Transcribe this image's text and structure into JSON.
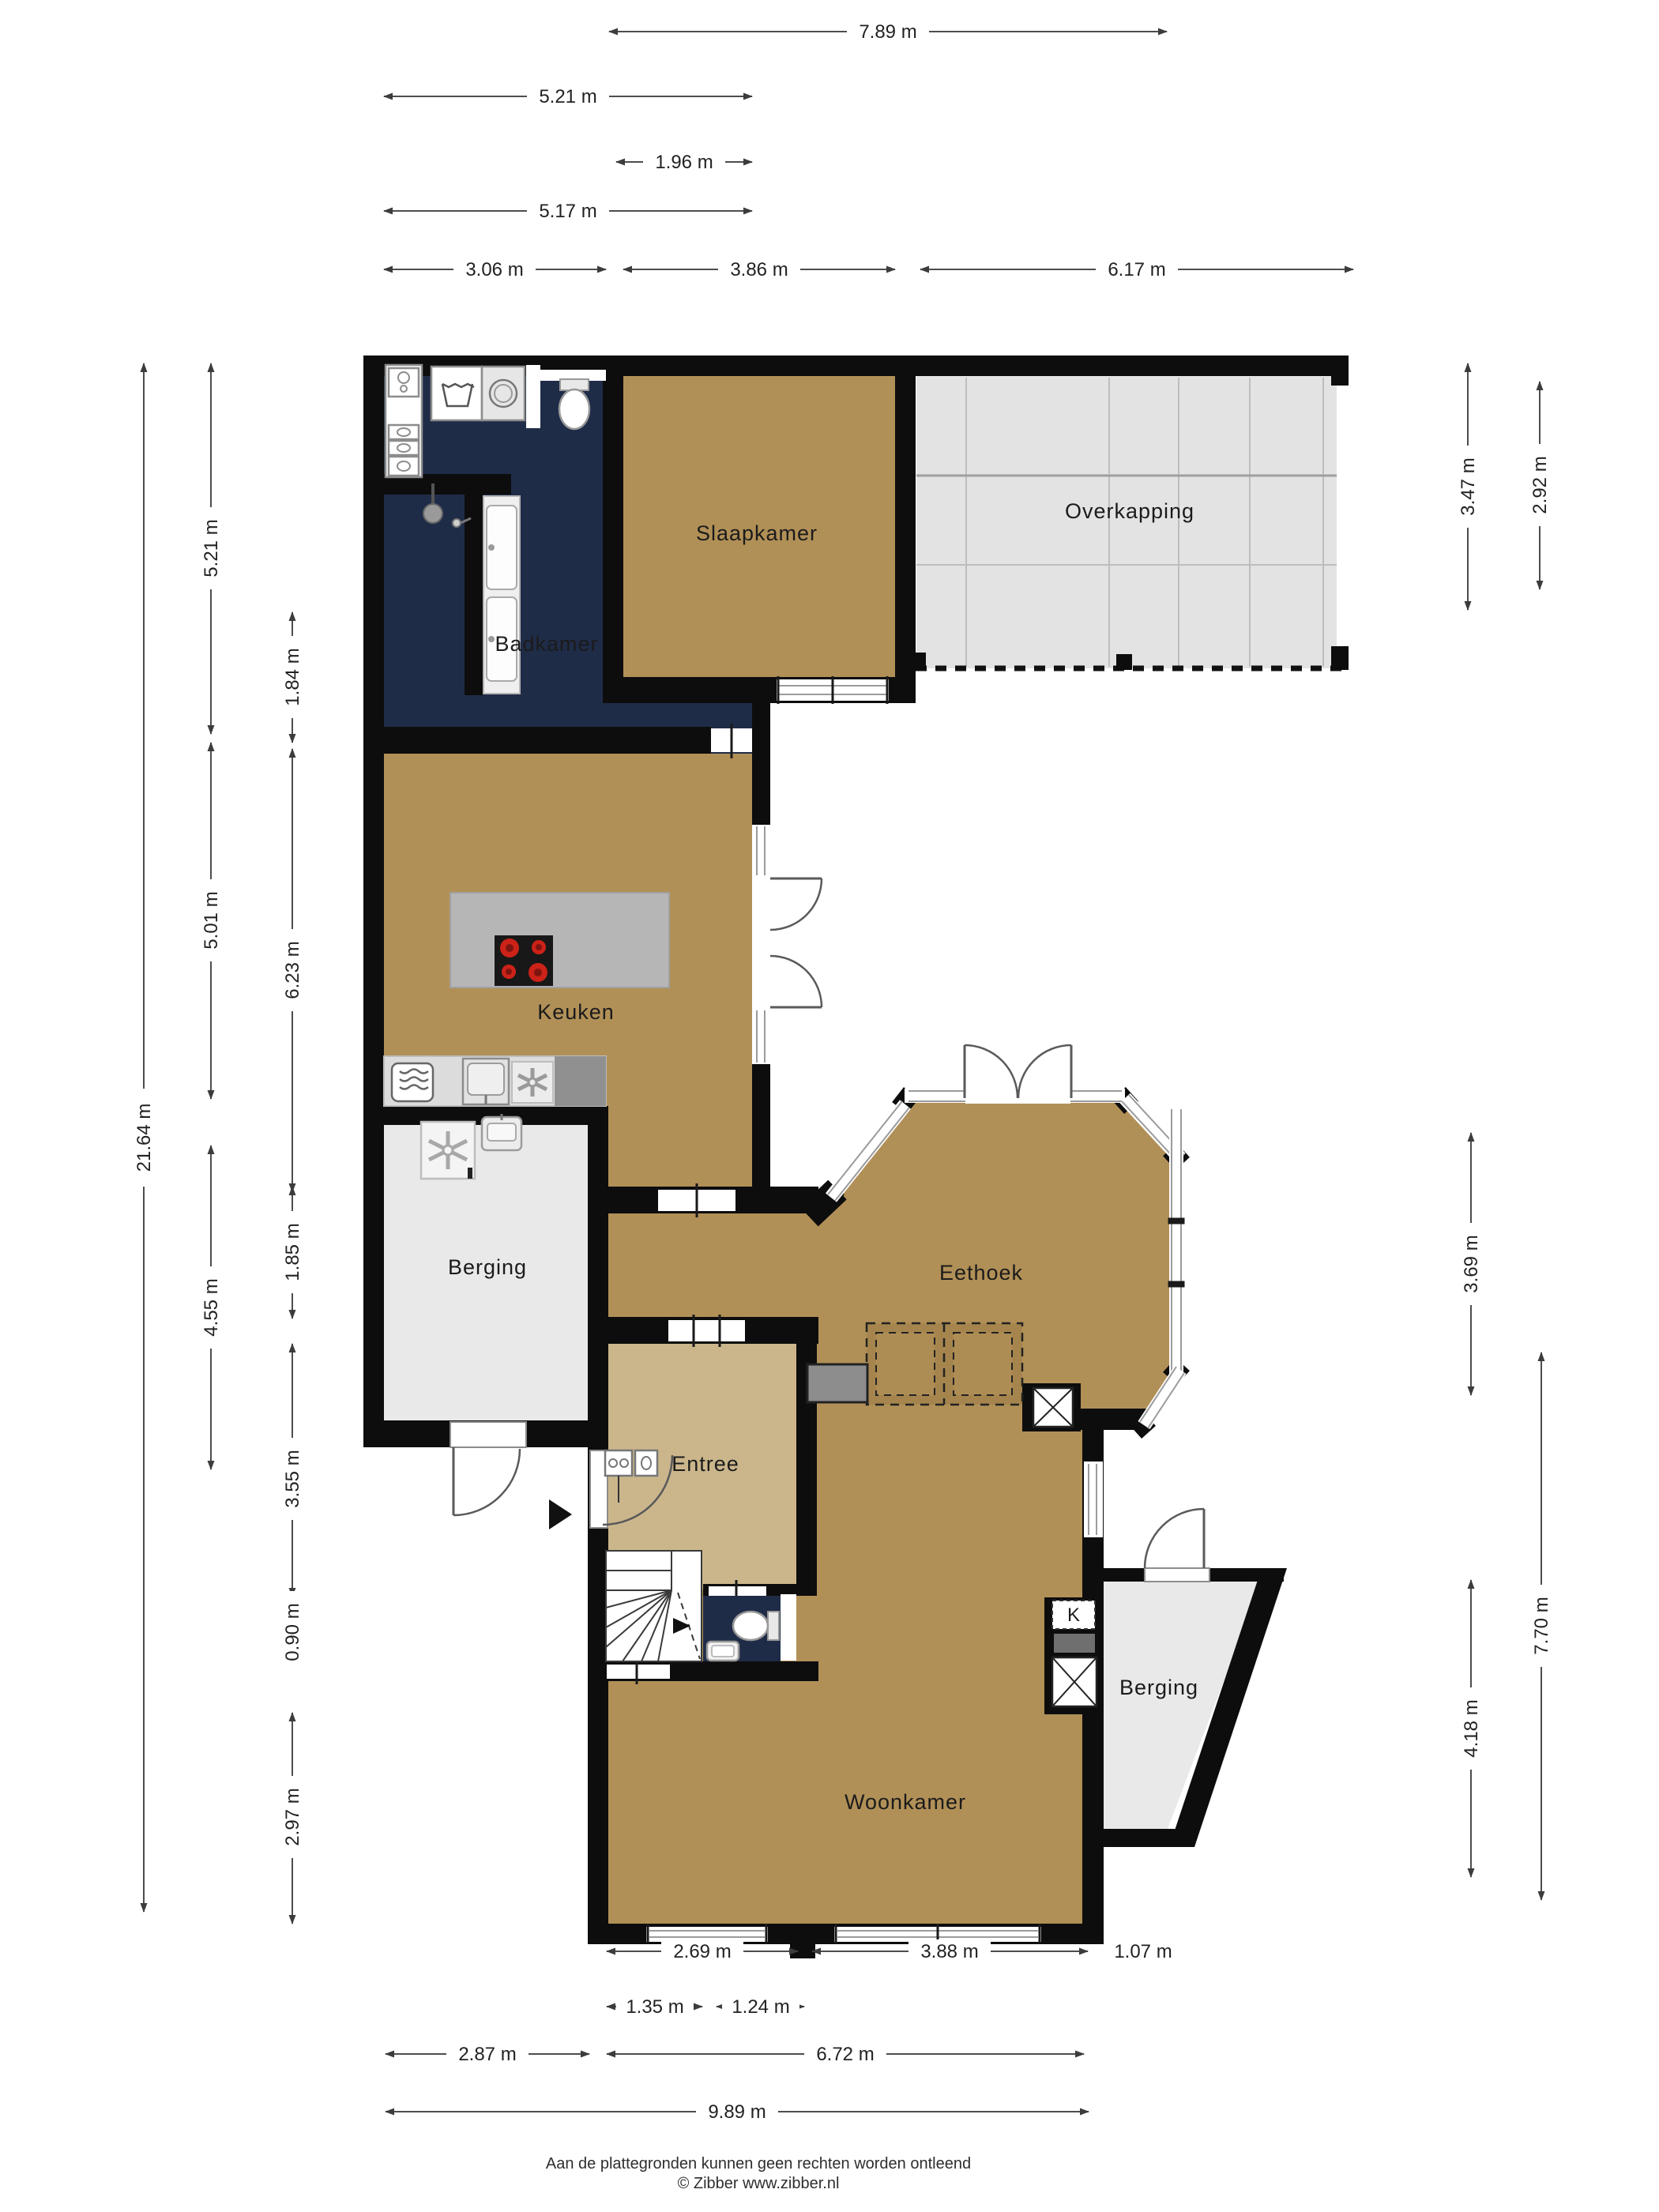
{
  "floorplan": {
    "rooms": {
      "slaapkamer": "Slaapkamer",
      "overkapping": "Overkapping",
      "badkamer": "Badkamer",
      "keuken": "Keuken",
      "berging_left": "Berging",
      "eethoek": "Eethoek",
      "entree": "Entree",
      "woonkamer": "Woonkamer",
      "berging_right": "Berging",
      "closet_k": "K"
    },
    "dimensions": {
      "top": [
        "7.89 m",
        "5.21 m",
        "1.96 m",
        "5.17 m",
        "3.06 m",
        "3.86 m",
        "6.17 m"
      ],
      "left": [
        "21.64 m",
        "5.21 m",
        "1.84 m",
        "5.01 m",
        "6.23 m",
        "4.55 m",
        "1.85 m",
        "3.55 m",
        "0.90 m",
        "2.97 m"
      ],
      "right": [
        "3.47 m",
        "2.92 m",
        "3.69 m",
        "7.70 m",
        "4.18 m"
      ],
      "bottom": [
        "2.69 m",
        "3.88 m",
        "1.07 m",
        "1.35 m",
        "1.24 m",
        "2.87 m",
        "6.72 m",
        "9.89 m"
      ]
    },
    "footer": {
      "line1": "Aan de plattegronden kunnen geen rechten worden ontleend",
      "line2": "© Zibber www.zibber.nl"
    },
    "colors": {
      "floor_main": "#b19057",
      "floor_entree": "#cbb68c",
      "floor_bath": "#1f2c48",
      "floor_storage": "#e9e9e9",
      "floor_canopy": "#e3e3e3",
      "wall": "#0d0d0d",
      "island": "#b6b6b6",
      "counter": "#dcdcdc",
      "burner_red": "#cc2218"
    }
  }
}
